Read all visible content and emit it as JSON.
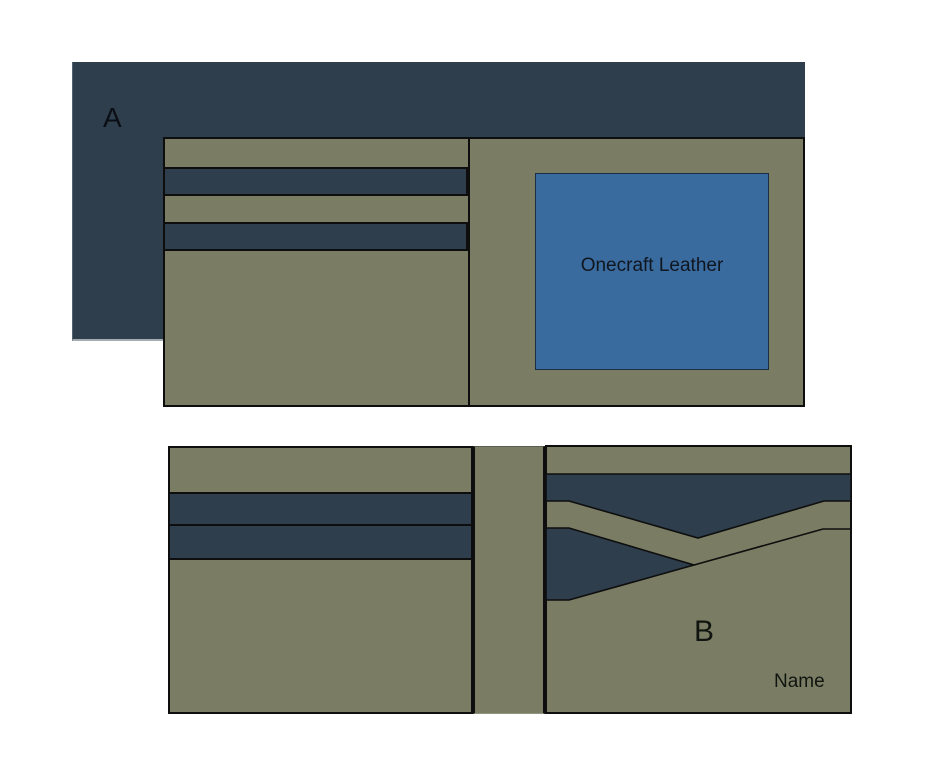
{
  "diagram": {
    "labels": {
      "panel_a": "A",
      "panel_b": "B",
      "brand_patch": "Onecraft Leather",
      "name_tag": "Name"
    },
    "colors": {
      "background": "#ffffff",
      "navy": "#2f3e4c",
      "olive": "#7a7d63",
      "blue": "#3a6b9f",
      "outline": "#0e0e0e"
    }
  }
}
